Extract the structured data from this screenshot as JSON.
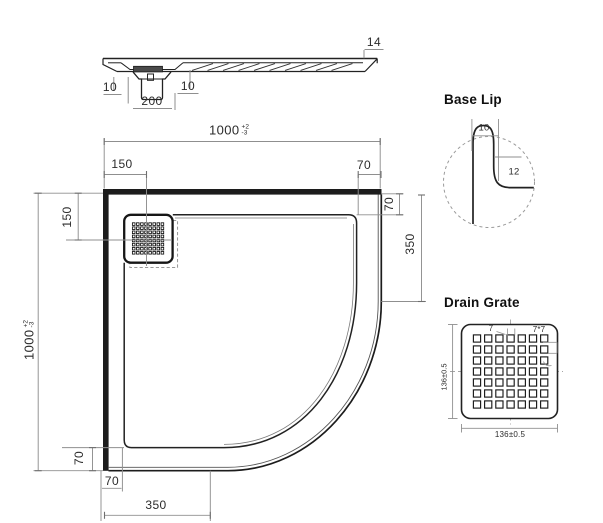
{
  "titles": {
    "base_lip": "Base Lip",
    "drain_grate": "Drain Grate"
  },
  "section": {
    "edge_thickness": "14",
    "lip_left": "10",
    "drain_recess": "200",
    "lip_right": "10"
  },
  "plan": {
    "width": "1000",
    "width_tol_plus": "+2",
    "width_tol_minus": "-3",
    "height": "1000",
    "height_tol_plus": "+2",
    "height_tol_minus": "-3",
    "drain_from_left": "150",
    "drain_from_top": "150",
    "top_right_border": "70",
    "right_border": "70",
    "right_radius_offset": "350",
    "bottom_left_border": "70",
    "bottom_border": "70",
    "bottom_radius_offset": "350"
  },
  "base_lip": {
    "lip_width": "10",
    "lip_height": "12"
  },
  "drain_grate": {
    "hole_size": "7",
    "hole_pattern": "7*7",
    "height": "136±0.5",
    "width": "136±0.5"
  },
  "colors": {
    "object_line": "#1c1c1c",
    "dim_line": "#8f8f8f",
    "text": "#2b2b2b",
    "background": "#ffffff"
  }
}
